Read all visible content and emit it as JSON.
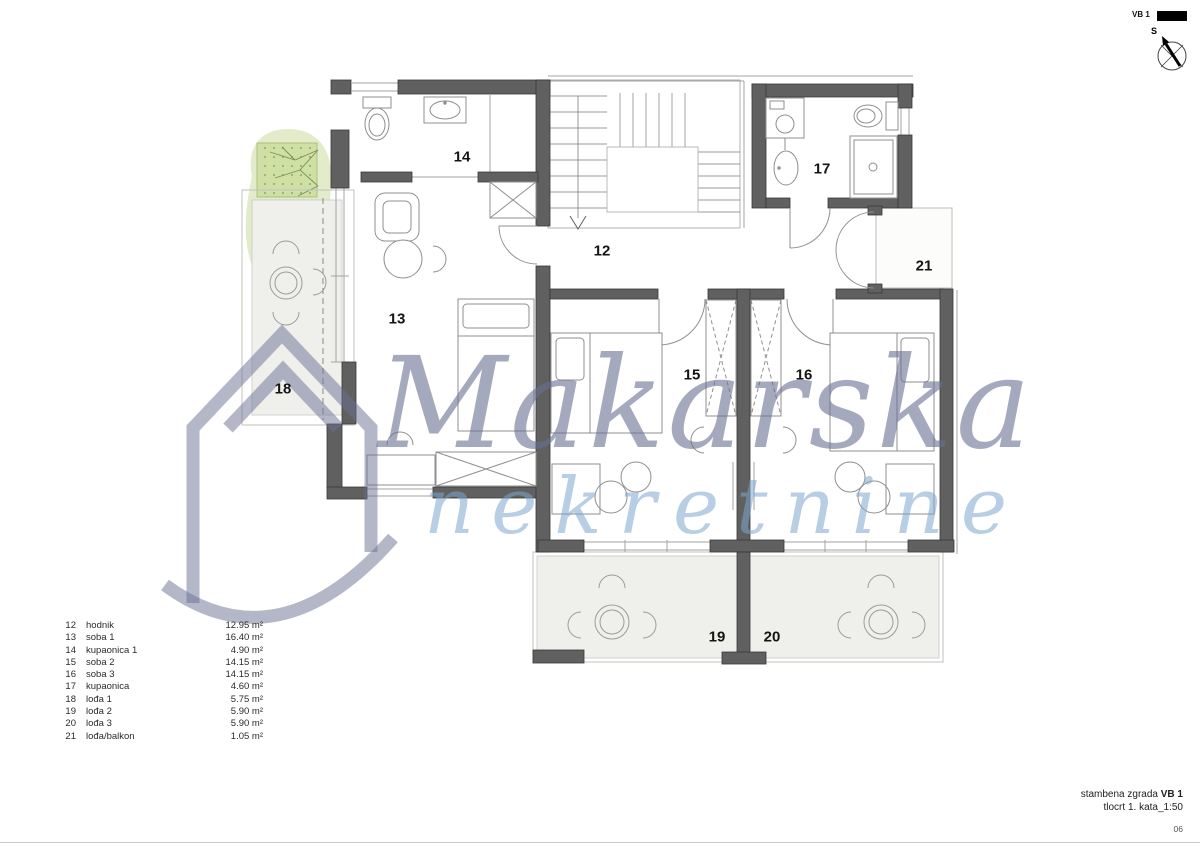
{
  "header": {
    "code": "VB 1"
  },
  "compass": {
    "label": "S"
  },
  "watermark": {
    "brand": "Makarska",
    "brand2": "nekretnine"
  },
  "plan": {
    "room_labels": [
      "12",
      "13",
      "14",
      "15",
      "16",
      "17",
      "18",
      "19",
      "20",
      "21"
    ]
  },
  "legend": {
    "rows": [
      {
        "num": "12",
        "name": "hodnik",
        "area": "12.95 m²"
      },
      {
        "num": "13",
        "name": "soba 1",
        "area": "16.40 m²"
      },
      {
        "num": "14",
        "name": "kupaonica 1",
        "area": "4.90 m²"
      },
      {
        "num": "15",
        "name": "soba 2",
        "area": "14.15 m²"
      },
      {
        "num": "16",
        "name": "soba 3",
        "area": "14.15 m²"
      },
      {
        "num": "17",
        "name": "kupaonica",
        "area": "4.60 m²"
      },
      {
        "num": "18",
        "name": "lođa 1",
        "area": "5.75 m²"
      },
      {
        "num": "19",
        "name": "lođa 2",
        "area": "5.90 m²"
      },
      {
        "num": "20",
        "name": "lođa 3",
        "area": "5.90 m²"
      },
      {
        "num": "21",
        "name": "lođa/balkon",
        "area": "1.05 m²"
      }
    ]
  },
  "title_block": {
    "project": "stambena zgrada",
    "code": "VB 1",
    "sheet": "tlocrt 1. kata_1:50",
    "page": "06"
  },
  "colors": {
    "wall": "#606060",
    "watermark_text": "#687092",
    "watermark_text2": "#7da6cd",
    "loggia_floor": "#efefec",
    "vegetation": "#dfe9c4"
  },
  "icons": {
    "compass": "north-arrow-icon",
    "logo": "house-logo-icon",
    "vegetation": "tree-symbol-icon"
  }
}
